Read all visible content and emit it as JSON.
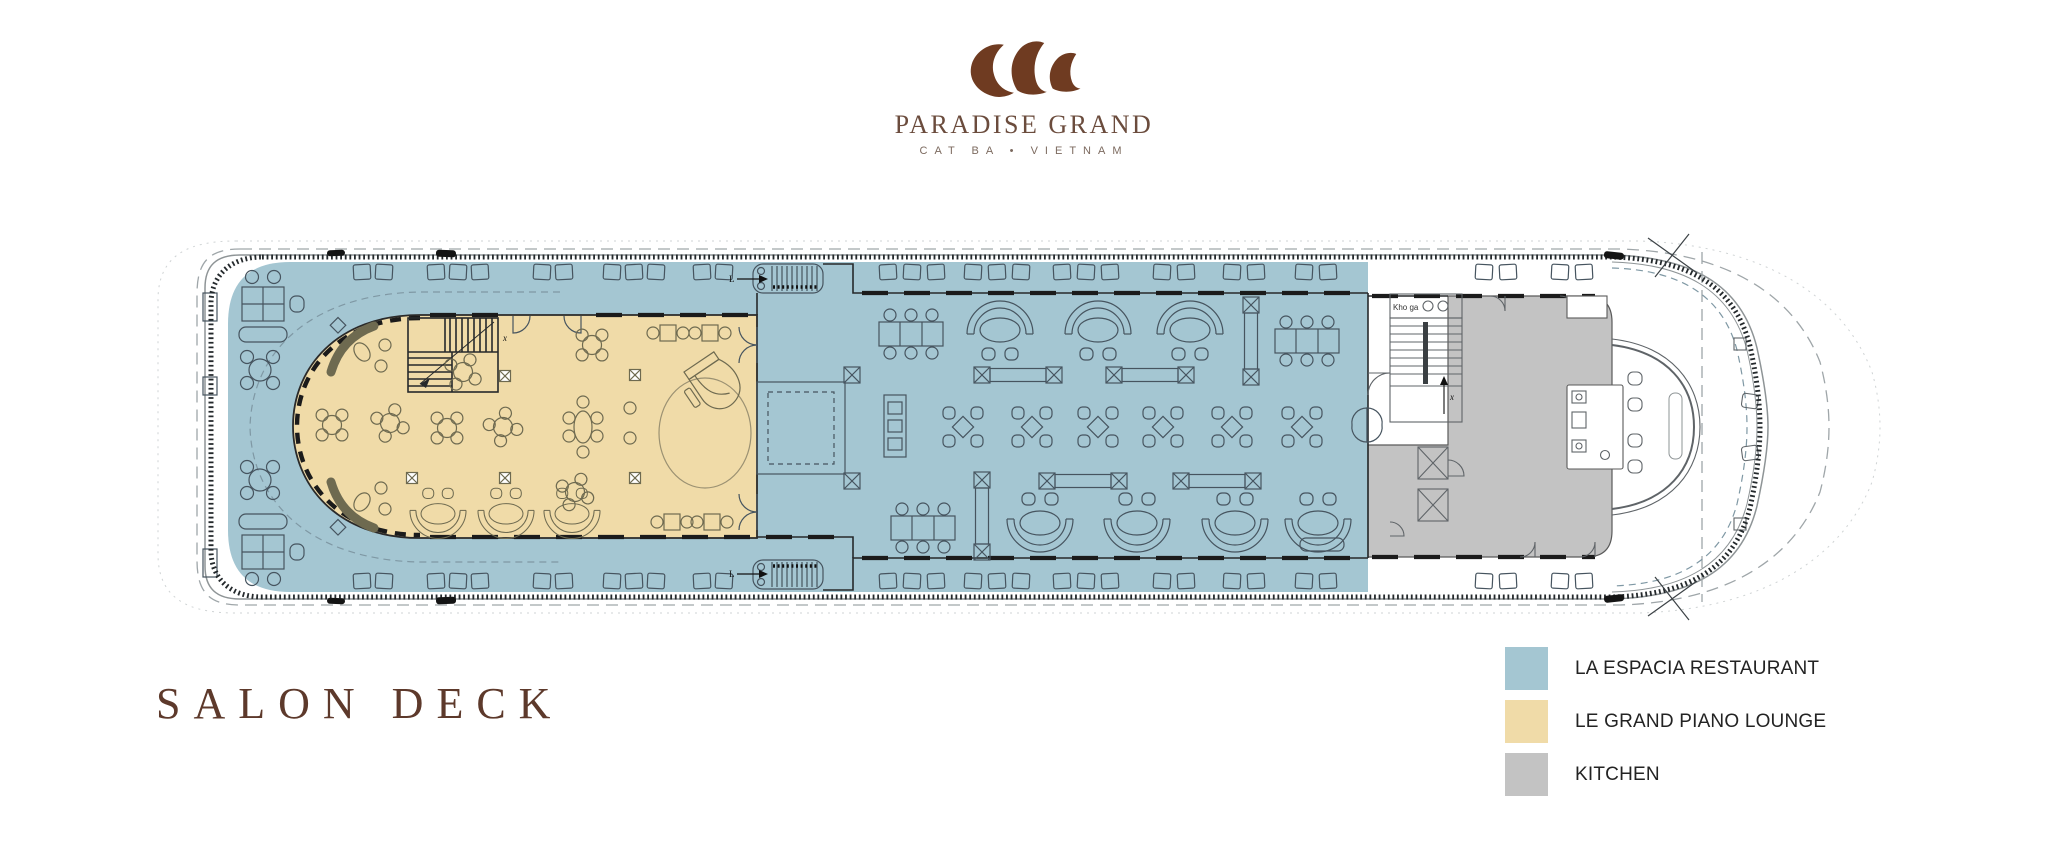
{
  "brand": {
    "name": "PARADISE GRAND",
    "location": "CAT BA • VIETNAM"
  },
  "deck": {
    "title": "SALON DECK"
  },
  "legend": [
    {
      "id": "restaurant",
      "label": "LA ESPACIA RESTAURANT"
    },
    {
      "id": "lounge",
      "label": "LE GRAND PIANO LOUNGE"
    },
    {
      "id": "kitchen",
      "label": "KITCHEN"
    }
  ],
  "plan": {
    "annotations": {
      "stairs_top": "L",
      "stairs_bottom": "L",
      "lounge_stairs_exit": "x",
      "stairwell_exit": "x",
      "kitchen_store_room": "Kho ga"
    }
  },
  "colors": {
    "restaurant": "#a4c6d2",
    "lounge": "#f0dba8",
    "kitchen": "#c3c3c3",
    "brand": "#6f3b21",
    "brand_text": "#6b4c3d",
    "brand_sub": "#7c6a5f",
    "title": "#5d392b",
    "legend_text": "#232323",
    "line": "#46545f",
    "lounge_line": "#6e6a50",
    "wall": "#1b1b1b",
    "hull": "#8e9496"
  }
}
